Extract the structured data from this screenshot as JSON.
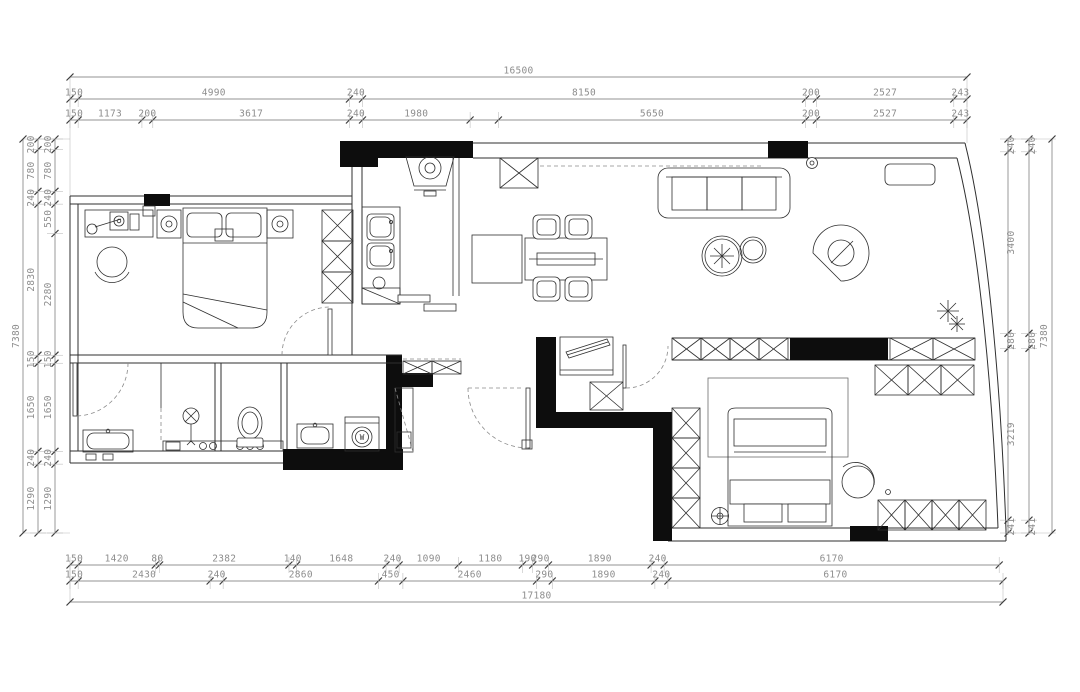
{
  "palette": {
    "bg": "#ffffff",
    "line": "#2f2f2f",
    "wall": "#0d0d0d",
    "dimline": "#6f6f6f",
    "dimtext": "#8d8d8d"
  },
  "dimensions": {
    "top": {
      "total": "16500",
      "row2": [
        "150",
        "4990",
        "240",
        "8150",
        "200",
        "2527",
        "243"
      ],
      "row3": [
        "150",
        "1173",
        "200",
        "3617",
        "240",
        "1980",
        "5650",
        "200",
        "2527",
        "243"
      ]
    },
    "bottom": {
      "row1": [
        "150",
        "1420",
        "80",
        "2382",
        "140",
        "1648",
        "240",
        "1090",
        "1180",
        "190",
        "290",
        "1890",
        "240",
        "6170"
      ],
      "row2": [
        "150",
        "2430",
        "240",
        "2860",
        "450",
        "2460",
        "290",
        "1890",
        "240",
        "6170"
      ],
      "total": "17180"
    },
    "left": {
      "total": "7380",
      "outer": [
        "200",
        "780",
        "240",
        "2830",
        "150",
        "1650",
        "240",
        "1290"
      ],
      "inner": [
        "200",
        "780",
        "240",
        "550",
        "2280",
        "150",
        "1650",
        "240",
        "1290"
      ]
    },
    "right": {
      "total": "7380",
      "inner": [
        "240",
        "3400",
        "280",
        "3219",
        "241"
      ],
      "outer": [
        "240",
        "280",
        "241"
      ]
    }
  },
  "symbols": {
    "washing_machine_label": "W"
  }
}
